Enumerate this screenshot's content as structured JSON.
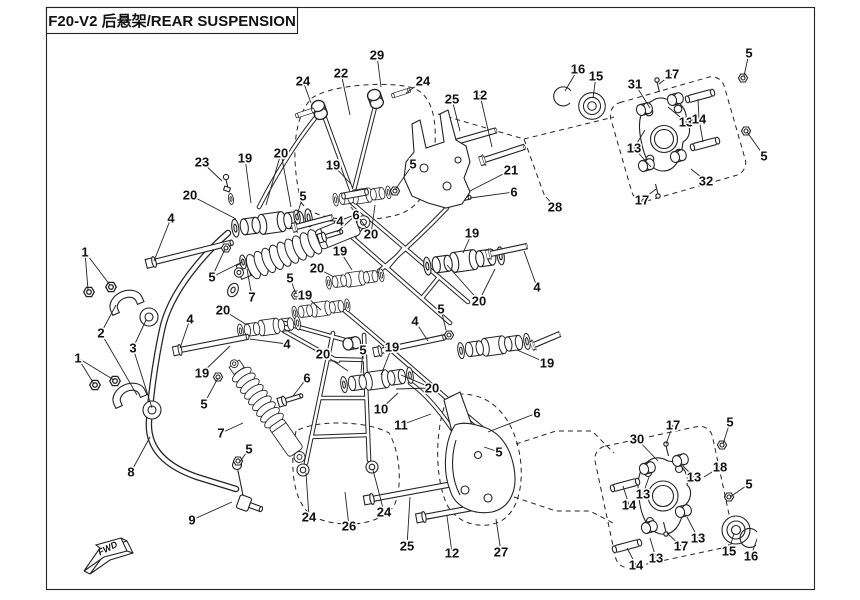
{
  "title": "F20-V2 后悬架/REAR SUSPENSION",
  "fwd_label": "FWD",
  "colors": {
    "line": "#232323",
    "background": "#ffffff"
  },
  "callouts": [
    {
      "n": "1",
      "x": 85,
      "y": 252,
      "leaders": [
        [
          88,
          290
        ],
        [
          110,
          285
        ]
      ]
    },
    {
      "n": "1",
      "x": 78,
      "y": 358,
      "leaders": [
        [
          94,
          384
        ],
        [
          114,
          380
        ]
      ]
    },
    {
      "n": "2",
      "x": 101,
      "y": 333,
      "leaders": [
        [
          116,
          305
        ],
        [
          137,
          395
        ]
      ]
    },
    {
      "n": "3",
      "x": 133,
      "y": 348,
      "leaders": [
        [
          146,
          320
        ],
        [
          152,
          408
        ]
      ]
    },
    {
      "n": "8",
      "x": 131,
      "y": 472,
      "leaders": [
        [
          150,
          437
        ]
      ]
    },
    {
      "n": "9",
      "x": 192,
      "y": 520,
      "leaders": [
        [
          232,
          502
        ]
      ]
    },
    {
      "n": "24",
      "x": 303,
      "y": 81,
      "leaders": [
        [
          311,
          103
        ]
      ]
    },
    {
      "n": "22",
      "x": 341,
      "y": 73,
      "leaders": [
        [
          350,
          115
        ]
      ]
    },
    {
      "n": "29",
      "x": 377,
      "y": 55,
      "leaders": [
        [
          381,
          87
        ]
      ]
    },
    {
      "n": "24",
      "x": 423,
      "y": 81,
      "leaders": [
        [
          406,
          93
        ]
      ]
    },
    {
      "n": "25",
      "x": 452,
      "y": 99,
      "leaders": [
        [
          460,
          131
        ]
      ]
    },
    {
      "n": "12",
      "x": 480,
      "y": 95,
      "leaders": [
        [
          492,
          147
        ]
      ]
    },
    {
      "n": "23",
      "x": 202,
      "y": 162,
      "leaders": [
        [
          222,
          181
        ]
      ]
    },
    {
      "n": "19",
      "x": 245,
      "y": 158,
      "leaders": [
        [
          251,
          203
        ]
      ]
    },
    {
      "n": "20",
      "x": 281,
      "y": 153,
      "leaders": [
        [
          266,
          205
        ],
        [
          291,
          207
        ]
      ]
    },
    {
      "n": "19",
      "x": 333,
      "y": 165,
      "leaders": [
        [
          351,
          184
        ]
      ]
    },
    {
      "n": "5",
      "x": 413,
      "y": 164,
      "leaders": [
        [
          395,
          190
        ]
      ]
    },
    {
      "n": "20",
      "x": 190,
      "y": 195,
      "leaders": [
        [
          236,
          219
        ]
      ]
    },
    {
      "n": "4",
      "x": 171,
      "y": 218,
      "leaders": [
        [
          154,
          261
        ]
      ]
    },
    {
      "n": "5",
      "x": 303,
      "y": 196,
      "leaders": [
        [
          297,
          215
        ]
      ]
    },
    {
      "n": "21",
      "x": 511,
      "y": 170,
      "leaders": [
        [
          470,
          191
        ]
      ]
    },
    {
      "n": "6",
      "x": 514,
      "y": 192,
      "leaders": [
        [
          470,
          198
        ]
      ]
    },
    {
      "n": "28",
      "x": 555,
      "y": 207,
      "leaders": [
        [
          546,
          197
        ]
      ]
    },
    {
      "n": "16",
      "x": 578,
      "y": 69,
      "leaders": [
        [
          565,
          91
        ]
      ]
    },
    {
      "n": "15",
      "x": 596,
      "y": 76,
      "leaders": [
        [
          593,
          98
        ]
      ]
    },
    {
      "n": "31",
      "x": 635,
      "y": 84,
      "leaders": [
        [
          650,
          108
        ]
      ]
    },
    {
      "n": "17",
      "x": 672,
      "y": 74,
      "leaders": [
        [
          659,
          84
        ]
      ]
    },
    {
      "n": "5",
      "x": 749,
      "y": 53,
      "leaders": [
        [
          744,
          76
        ]
      ]
    },
    {
      "n": "13",
      "x": 686,
      "y": 122,
      "leaders": [
        [
          668,
          107
        ]
      ]
    },
    {
      "n": "14",
      "x": 699,
      "y": 119,
      "leaders": [
        [
          698,
          99
        ],
        [
          703,
          142
        ]
      ]
    },
    {
      "n": "13",
      "x": 634,
      "y": 148,
      "leaders": [
        [
          645,
          130
        ],
        [
          651,
          167
        ]
      ]
    },
    {
      "n": "5",
      "x": 764,
      "y": 156,
      "leaders": [
        [
          747,
          132
        ]
      ]
    },
    {
      "n": "32",
      "x": 706,
      "y": 181,
      "leaders": [
        [
          691,
          169
        ]
      ]
    },
    {
      "n": "17",
      "x": 642,
      "y": 200,
      "leaders": [
        [
          656,
          189
        ]
      ]
    },
    {
      "n": "6",
      "x": 356,
      "y": 215,
      "leaders": [
        [
          337,
          232
        ]
      ]
    },
    {
      "n": "20",
      "x": 371,
      "y": 234,
      "leaders": [
        [
          351,
          207
        ],
        [
          375,
          205
        ]
      ]
    },
    {
      "n": "4",
      "x": 340,
      "y": 221,
      "leaders": [
        [
          328,
          221
        ]
      ]
    },
    {
      "n": "19",
      "x": 340,
      "y": 251,
      "leaders": [
        [
          352,
          270
        ]
      ]
    },
    {
      "n": "7",
      "x": 252,
      "y": 297,
      "leaders": [
        [
          247,
          269
        ]
      ]
    },
    {
      "n": "5",
      "x": 212,
      "y": 277,
      "leaders": [
        [
          225,
          249
        ],
        [
          242,
          262
        ]
      ]
    },
    {
      "n": "20",
      "x": 317,
      "y": 268,
      "leaders": [
        [
          334,
          277
        ]
      ]
    },
    {
      "n": "5",
      "x": 290,
      "y": 278,
      "leaders": [
        [
          296,
          294
        ]
      ]
    },
    {
      "n": "19",
      "x": 305,
      "y": 295,
      "leaders": [
        [
          321,
          310
        ]
      ]
    },
    {
      "n": "20",
      "x": 223,
      "y": 310,
      "leaders": [
        [
          247,
          325
        ]
      ]
    },
    {
      "n": "4",
      "x": 190,
      "y": 319,
      "leaders": [
        [
          180,
          348
        ]
      ]
    },
    {
      "n": "19",
      "x": 202,
      "y": 373,
      "leaders": [
        [
          230,
          346
        ]
      ]
    },
    {
      "n": "5",
      "x": 204,
      "y": 404,
      "leaders": [
        [
          218,
          378
        ]
      ]
    },
    {
      "n": "19",
      "x": 472,
      "y": 233,
      "leaders": [
        [
          463,
          253
        ]
      ]
    },
    {
      "n": "4",
      "x": 537,
      "y": 287,
      "leaders": [
        [
          524,
          251
        ]
      ]
    },
    {
      "n": "20",
      "x": 479,
      "y": 301,
      "leaders": [
        [
          447,
          265
        ],
        [
          495,
          269
        ]
      ]
    },
    {
      "n": "5",
      "x": 441,
      "y": 309,
      "leaders": [
        [
          446,
          330
        ]
      ]
    },
    {
      "n": "4",
      "x": 415,
      "y": 321,
      "leaders": [
        [
          428,
          341
        ]
      ]
    },
    {
      "n": "19",
      "x": 547,
      "y": 363,
      "leaders": [
        [
          517,
          350
        ]
      ]
    },
    {
      "n": "6",
      "x": 537,
      "y": 413,
      "leaders": [
        [
          488,
          432
        ]
      ]
    },
    {
      "n": "5",
      "x": 499,
      "y": 452,
      "leaders": [
        [
          484,
          447
        ]
      ]
    },
    {
      "n": "20",
      "x": 323,
      "y": 354,
      "leaders": [
        [
          348,
          371
        ]
      ]
    },
    {
      "n": "5",
      "x": 363,
      "y": 350,
      "leaders": [
        [
          361,
          373
        ]
      ]
    },
    {
      "n": "19",
      "x": 392,
      "y": 347,
      "leaders": [
        [
          381,
          375
        ]
      ]
    },
    {
      "n": "20",
      "x": 432,
      "y": 388,
      "leaders": [
        [
          401,
          375
        ],
        [
          396,
          389
        ]
      ]
    },
    {
      "n": "4",
      "x": 287,
      "y": 344,
      "leaders": [
        [
          250,
          339
        ]
      ]
    },
    {
      "n": "6",
      "x": 307,
      "y": 378,
      "leaders": [
        [
          293,
          396
        ]
      ]
    },
    {
      "n": "10",
      "x": 381,
      "y": 409,
      "leaders": [
        [
          398,
          393
        ]
      ]
    },
    {
      "n": "11",
      "x": 401,
      "y": 425,
      "leaders": [
        [
          431,
          414
        ]
      ]
    },
    {
      "n": "7",
      "x": 221,
      "y": 433,
      "leaders": [
        [
          243,
          423
        ]
      ]
    },
    {
      "n": "5",
      "x": 249,
      "y": 449,
      "leaders": [
        [
          239,
          463
        ]
      ]
    },
    {
      "n": "24",
      "x": 309,
      "y": 517,
      "leaders": [
        [
          306,
          473
        ]
      ]
    },
    {
      "n": "26",
      "x": 349,
      "y": 526,
      "leaders": [
        [
          345,
          492
        ]
      ]
    },
    {
      "n": "24",
      "x": 384,
      "y": 512,
      "leaders": [
        [
          373,
          470
        ]
      ]
    },
    {
      "n": "25",
      "x": 407,
      "y": 546,
      "leaders": [
        [
          410,
          497
        ]
      ]
    },
    {
      "n": "12",
      "x": 452,
      "y": 553,
      "leaders": [
        [
          447,
          516
        ]
      ]
    },
    {
      "n": "27",
      "x": 501,
      "y": 552,
      "leaders": [
        [
          496,
          519
        ]
      ]
    },
    {
      "n": "30",
      "x": 637,
      "y": 439,
      "leaders": [
        [
          658,
          461
        ]
      ]
    },
    {
      "n": "17",
      "x": 673,
      "y": 425,
      "leaders": [
        [
          666,
          444
        ]
      ]
    },
    {
      "n": "5",
      "x": 730,
      "y": 422,
      "leaders": [
        [
          723,
          444
        ]
      ]
    },
    {
      "n": "18",
      "x": 720,
      "y": 467,
      "leaders": [
        [
          704,
          477
        ]
      ]
    },
    {
      "n": "13",
      "x": 694,
      "y": 477,
      "leaders": [
        [
          683,
          466
        ]
      ]
    },
    {
      "n": "13",
      "x": 643,
      "y": 494,
      "leaders": [
        [
          649,
          477
        ]
      ]
    },
    {
      "n": "14",
      "x": 629,
      "y": 505,
      "leaders": [
        [
          623,
          486
        ]
      ]
    },
    {
      "n": "5",
      "x": 749,
      "y": 484,
      "leaders": [
        [
          730,
          497
        ]
      ]
    },
    {
      "n": "13",
      "x": 698,
      "y": 538,
      "leaders": [
        [
          687,
          517
        ]
      ]
    },
    {
      "n": "15",
      "x": 729,
      "y": 551,
      "leaders": [
        [
          734,
          533
        ]
      ]
    },
    {
      "n": "16",
      "x": 751,
      "y": 556,
      "leaders": [
        [
          757,
          539
        ]
      ]
    },
    {
      "n": "17",
      "x": 681,
      "y": 546,
      "leaders": [
        [
          667,
          533
        ]
      ]
    },
    {
      "n": "13",
      "x": 656,
      "y": 558,
      "leaders": [
        [
          650,
          538
        ]
      ]
    },
    {
      "n": "14",
      "x": 636,
      "y": 565,
      "leaders": [
        [
          627,
          548
        ]
      ]
    }
  ]
}
